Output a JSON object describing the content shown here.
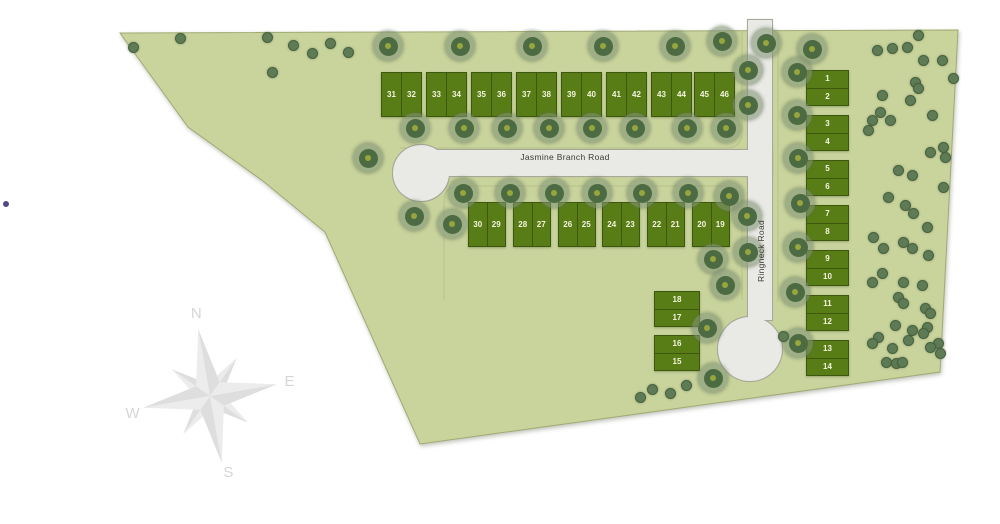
{
  "site": {
    "fill": "#c9d39c",
    "stroke": "#9fab72"
  },
  "roads": {
    "fill": "#e9e9e5",
    "stroke": "#a8a899",
    "jasmine": {
      "label": "Jasmine Branch Road"
    },
    "ringneck": {
      "label": "Ringneck Road"
    }
  },
  "lots": {
    "fill": "#597d16",
    "stroke": "#3d570e",
    "number_color": "#f2f4de",
    "groups": [
      {
        "name": "top-row",
        "orient": "h",
        "y": 72,
        "h": 45,
        "w": 41,
        "starts": [
          381,
          426,
          471,
          516,
          561,
          606,
          651,
          694
        ],
        "pairs": [
          [
            "31",
            "32"
          ],
          [
            "33",
            "34"
          ],
          [
            "35",
            "36"
          ],
          [
            "37",
            "38"
          ],
          [
            "39",
            "40"
          ],
          [
            "41",
            "42"
          ],
          [
            "43",
            "44"
          ],
          [
            "45",
            "46"
          ]
        ]
      },
      {
        "name": "second-row",
        "orient": "h",
        "y": 202,
        "h": 45,
        "w": 38,
        "starts": [
          468,
          513,
          558,
          602,
          647,
          692
        ],
        "pairs": [
          [
            "30",
            "29"
          ],
          [
            "28",
            "27"
          ],
          [
            "26",
            "25"
          ],
          [
            "24",
            "23"
          ],
          [
            "22",
            "21"
          ],
          [
            "20",
            "19"
          ]
        ]
      },
      {
        "name": "east-column",
        "orient": "v",
        "x": 806,
        "w": 43,
        "h": 36,
        "starts": [
          70,
          115,
          160,
          205,
          250,
          295,
          340
        ],
        "pairs": [
          [
            "1",
            "2"
          ],
          [
            "3",
            "4"
          ],
          [
            "5",
            "6"
          ],
          [
            "7",
            "8"
          ],
          [
            "9",
            "10"
          ],
          [
            "11",
            "12"
          ],
          [
            "13",
            "14"
          ]
        ]
      },
      {
        "name": "west-blocks",
        "orient": "v",
        "x": 654,
        "w": 46,
        "h": 36,
        "starts": [
          291,
          335
        ],
        "pairs": [
          [
            "18",
            "17"
          ],
          [
            "16",
            "15"
          ]
        ]
      }
    ]
  },
  "compass": {
    "letters": {
      "n": "N",
      "e": "E",
      "w": "W",
      "s": "S"
    },
    "letter_color": "#cfcfcf",
    "light": "#e9e9e9",
    "dark": "#d9d9d9"
  },
  "trees": {
    "big": [
      [
        388,
        46
      ],
      [
        460,
        46
      ],
      [
        532,
        46
      ],
      [
        603,
        46
      ],
      [
        675,
        46
      ],
      [
        722,
        41
      ],
      [
        766,
        43
      ],
      [
        812,
        49
      ],
      [
        415,
        128
      ],
      [
        464,
        128
      ],
      [
        507,
        128
      ],
      [
        549,
        128
      ],
      [
        592,
        128
      ],
      [
        635,
        128
      ],
      [
        687,
        128
      ],
      [
        726,
        128
      ],
      [
        368,
        158
      ],
      [
        414,
        216
      ],
      [
        452,
        224
      ],
      [
        463,
        193
      ],
      [
        510,
        193
      ],
      [
        554,
        193
      ],
      [
        597,
        193
      ],
      [
        642,
        193
      ],
      [
        688,
        193
      ],
      [
        729,
        196
      ],
      [
        747,
        216
      ],
      [
        713,
        259
      ],
      [
        748,
        252
      ],
      [
        748,
        70
      ],
      [
        748,
        105
      ],
      [
        797,
        72
      ],
      [
        797,
        115
      ],
      [
        798,
        158
      ],
      [
        800,
        203
      ],
      [
        798,
        247
      ],
      [
        795,
        292
      ],
      [
        798,
        343
      ],
      [
        725,
        285
      ],
      [
        707,
        328
      ],
      [
        713,
        378
      ]
    ],
    "small": [
      [
        133,
        47
      ],
      [
        180,
        38
      ],
      [
        267,
        37
      ],
      [
        293,
        45
      ],
      [
        312,
        53
      ],
      [
        330,
        43
      ],
      [
        348,
        52
      ],
      [
        272,
        72
      ],
      [
        640,
        397
      ],
      [
        652,
        389
      ],
      [
        670,
        393
      ],
      [
        686,
        385
      ],
      [
        783,
        336
      ],
      [
        877,
        50
      ],
      [
        892,
        48
      ],
      [
        907,
        47
      ],
      [
        918,
        35
      ],
      [
        923,
        60
      ],
      [
        942,
        60
      ],
      [
        953,
        78
      ],
      [
        915,
        82
      ],
      [
        918,
        88
      ],
      [
        882,
        95
      ],
      [
        910,
        100
      ],
      [
        880,
        112
      ],
      [
        872,
        120
      ],
      [
        890,
        120
      ],
      [
        932,
        115
      ],
      [
        868,
        130
      ],
      [
        943,
        147
      ],
      [
        930,
        152
      ],
      [
        945,
        157
      ],
      [
        898,
        170
      ],
      [
        912,
        175
      ],
      [
        943,
        187
      ],
      [
        888,
        197
      ],
      [
        905,
        205
      ],
      [
        913,
        213
      ],
      [
        927,
        227
      ],
      [
        873,
        237
      ],
      [
        883,
        248
      ],
      [
        903,
        242
      ],
      [
        912,
        248
      ],
      [
        928,
        255
      ],
      [
        882,
        273
      ],
      [
        872,
        282
      ],
      [
        903,
        282
      ],
      [
        922,
        285
      ],
      [
        898,
        297
      ],
      [
        925,
        308
      ],
      [
        903,
        303
      ],
      [
        930,
        313
      ],
      [
        895,
        325
      ],
      [
        927,
        327
      ],
      [
        912,
        330
      ],
      [
        923,
        333
      ],
      [
        938,
        343
      ],
      [
        878,
        337
      ],
      [
        872,
        343
      ],
      [
        908,
        340
      ],
      [
        930,
        347
      ],
      [
        892,
        348
      ],
      [
        940,
        353
      ],
      [
        886,
        362
      ],
      [
        896,
        363
      ],
      [
        902,
        362
      ]
    ]
  },
  "marker_dot": {
    "color": "#41337a"
  }
}
